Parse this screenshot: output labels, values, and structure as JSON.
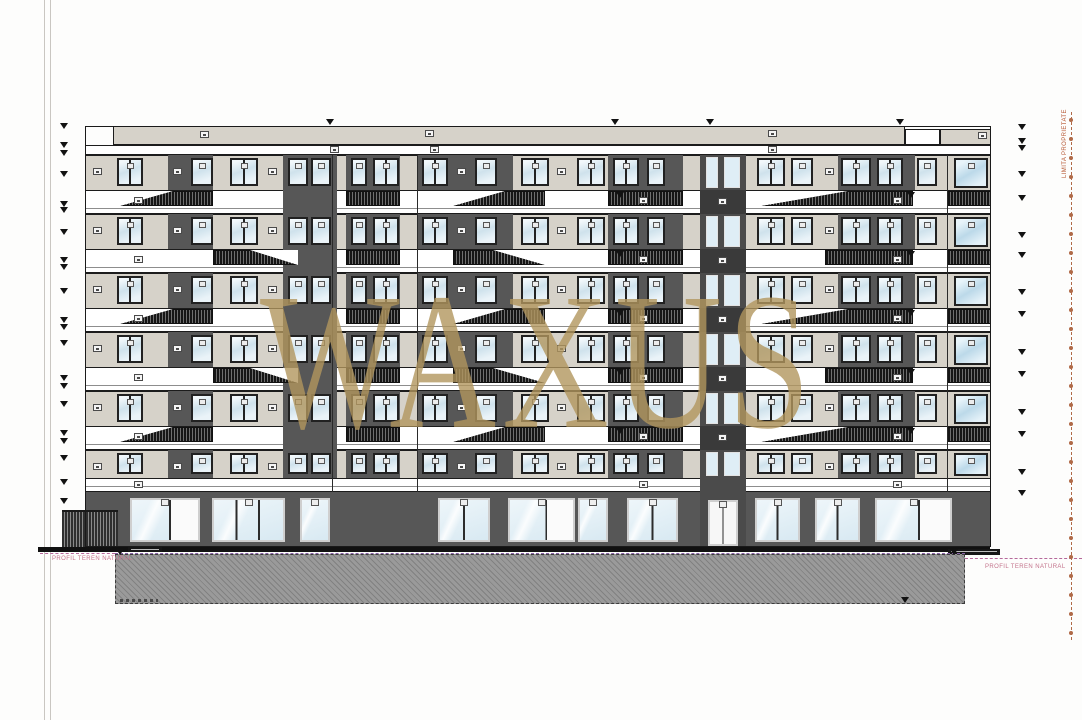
{
  "watermark": {
    "text": "WAXUS",
    "color": "rgba(177,150,94,0.8)"
  },
  "labels": {
    "profil_teren_left": "PROFIL TEREN NATURAL",
    "profil_teren_right": "PROFIL TEREN NATURAL",
    "limita_proprietate": "LIMITA PROPRIETATE"
  },
  "palette": {
    "wall": "#d6d2c9",
    "dark_panel": "#575757",
    "tower": "#4b4b4b",
    "tower_band": "#3a3a3a",
    "storefront": "#575757",
    "outline": "#1a1a1a",
    "ground_line": "#111111",
    "hatch_gray": "#9a9a9a",
    "pink": "#c4748c",
    "purple": "#8a63a8",
    "property": "#b06a48",
    "gold": "#b1965e"
  },
  "sheet": {
    "edge_lines_x": [
      44,
      50
    ]
  },
  "building": {
    "x": 85,
    "w": 906,
    "top": 126,
    "bottom": 547,
    "parapet": {
      "segments": [
        {
          "x": 113,
          "w": 792,
          "y": 126,
          "h": 19,
          "fill": "wall"
        },
        {
          "x": 905,
          "w": 35,
          "y": 129,
          "h": 16,
          "fill": "white"
        },
        {
          "x": 940,
          "w": 51,
          "y": 129,
          "h": 16,
          "fill": "wall"
        }
      ],
      "labels": [
        [
          200,
          131
        ],
        [
          425,
          130
        ],
        [
          768,
          130
        ],
        [
          978,
          132
        ]
      ]
    },
    "fascia": {
      "y": 145,
      "h": 10,
      "labels": [
        330,
        430,
        768
      ]
    },
    "floors": {
      "count": 6,
      "wall_top0": 155,
      "pitch": 59,
      "wall_h": 35,
      "slab_h": 24,
      "last_wall_h": 28
    },
    "bottom_slab": {
      "y": 478,
      "h": 14
    },
    "pattern": {
      "dark_patches": [
        [
          83,
          45
        ],
        [
          198,
          54
        ],
        [
          261,
          54
        ],
        [
          333,
          95
        ],
        [
          523,
          75
        ],
        [
          753,
          77
        ]
      ],
      "windows": [
        [
          8,
          14,
          "s"
        ],
        [
          32,
          26,
          "t2"
        ],
        [
          88,
          13,
          "s"
        ],
        [
          106,
          22,
          "t"
        ],
        [
          145,
          28,
          "t2"
        ],
        [
          183,
          12,
          "s"
        ],
        [
          203,
          20,
          "t"
        ],
        [
          226,
          20,
          "t"
        ],
        [
          266,
          16,
          "t"
        ],
        [
          288,
          26,
          "t2"
        ],
        [
          337,
          26,
          "t2"
        ],
        [
          372,
          12,
          "s"
        ],
        [
          390,
          22,
          "t"
        ],
        [
          436,
          28,
          "t2"
        ],
        [
          472,
          12,
          "s"
        ],
        [
          492,
          28,
          "t2"
        ],
        [
          528,
          26,
          "t2"
        ],
        [
          562,
          18,
          "t"
        ],
        [
          672,
          28,
          "t2"
        ],
        [
          706,
          22,
          "t"
        ],
        [
          740,
          12,
          "s"
        ],
        [
          756,
          30,
          "t2"
        ],
        [
          792,
          26,
          "t2"
        ],
        [
          832,
          20,
          "t"
        ],
        [
          869,
          34,
          "big"
        ]
      ],
      "railings_even": [
        [
          35,
          93,
          "L"
        ],
        [
          261,
          54,
          ""
        ],
        [
          368,
          92,
          "L"
        ],
        [
          523,
          75,
          ""
        ],
        [
          676,
          152,
          "L"
        ],
        [
          862,
          44,
          ""
        ]
      ],
      "railings_odd": [
        [
          128,
          85,
          "R"
        ],
        [
          261,
          54,
          ""
        ],
        [
          368,
          92,
          "R"
        ],
        [
          523,
          75,
          ""
        ],
        [
          740,
          88,
          ""
        ],
        [
          862,
          44,
          ""
        ]
      ],
      "slab_dark": [
        [
          198,
          54
        ]
      ],
      "slab_labels": [
        49,
        554,
        808
      ],
      "slab_markers": [
        531,
        822
      ],
      "joints": [
        247,
        332,
        862
      ]
    },
    "tower": {
      "x": 615,
      "w": 46,
      "top": 155,
      "windows": [
        [
          6,
          12
        ],
        [
          24,
          16
        ]
      ],
      "door": {
        "x": 8,
        "w": 30,
        "y": 500,
        "h": 46
      }
    },
    "storefront": {
      "y": 492,
      "h": 55,
      "units": [
        [
          45,
          70,
          "g2d"
        ],
        [
          127,
          73,
          "g3"
        ],
        [
          215,
          30,
          "g"
        ],
        [
          353,
          52,
          "g2"
        ],
        [
          423,
          67,
          "g2d"
        ],
        [
          493,
          30,
          "g"
        ],
        [
          542,
          51,
          "g2"
        ],
        [
          670,
          45,
          "g2"
        ],
        [
          730,
          45,
          "g2"
        ],
        [
          790,
          77,
          "g2d"
        ]
      ]
    },
    "fence": {
      "x": 62,
      "y": 510,
      "w": 56,
      "h": 37
    }
  },
  "ground": {
    "line": {
      "x": 38,
      "w": 952,
      "y": 547,
      "h": 5
    },
    "plates": [
      [
        128,
        547,
        34,
        5
      ],
      [
        948,
        549,
        52,
        6
      ]
    ],
    "hatch": {
      "x": 115,
      "y": 554,
      "w": 850,
      "h": 50
    },
    "scribble": {
      "x": 120,
      "y": 599,
      "w": 38
    },
    "left_dash": {
      "x": 40,
      "y": 553,
      "w": 75
    },
    "right_dash": {
      "x": 965,
      "y": 558,
      "w": 117
    },
    "left_text_xy": [
      52,
      556
    ],
    "right_text_xy": [
      985,
      564
    ]
  },
  "markers": {
    "left_x": 60,
    "left_y": [
      123,
      142,
      150,
      171,
      201,
      207,
      229,
      257,
      264,
      288,
      317,
      324,
      340,
      375,
      383,
      401,
      430,
      438,
      455,
      479,
      498
    ],
    "right_x": 1018,
    "right_y": [
      124,
      138,
      145,
      171,
      195,
      232,
      252,
      289,
      311,
      349,
      371,
      409,
      431,
      469,
      490
    ],
    "roof": [
      [
        326,
        119
      ],
      [
        611,
        119
      ],
      [
        706,
        119
      ],
      [
        896,
        119
      ]
    ],
    "ground": [
      [
        116,
        549
      ],
      [
        950,
        549
      ],
      [
        901,
        597
      ]
    ]
  },
  "property_line": {
    "x": 1071,
    "y1": 112,
    "y2": 640,
    "circle_gap": 19
  }
}
